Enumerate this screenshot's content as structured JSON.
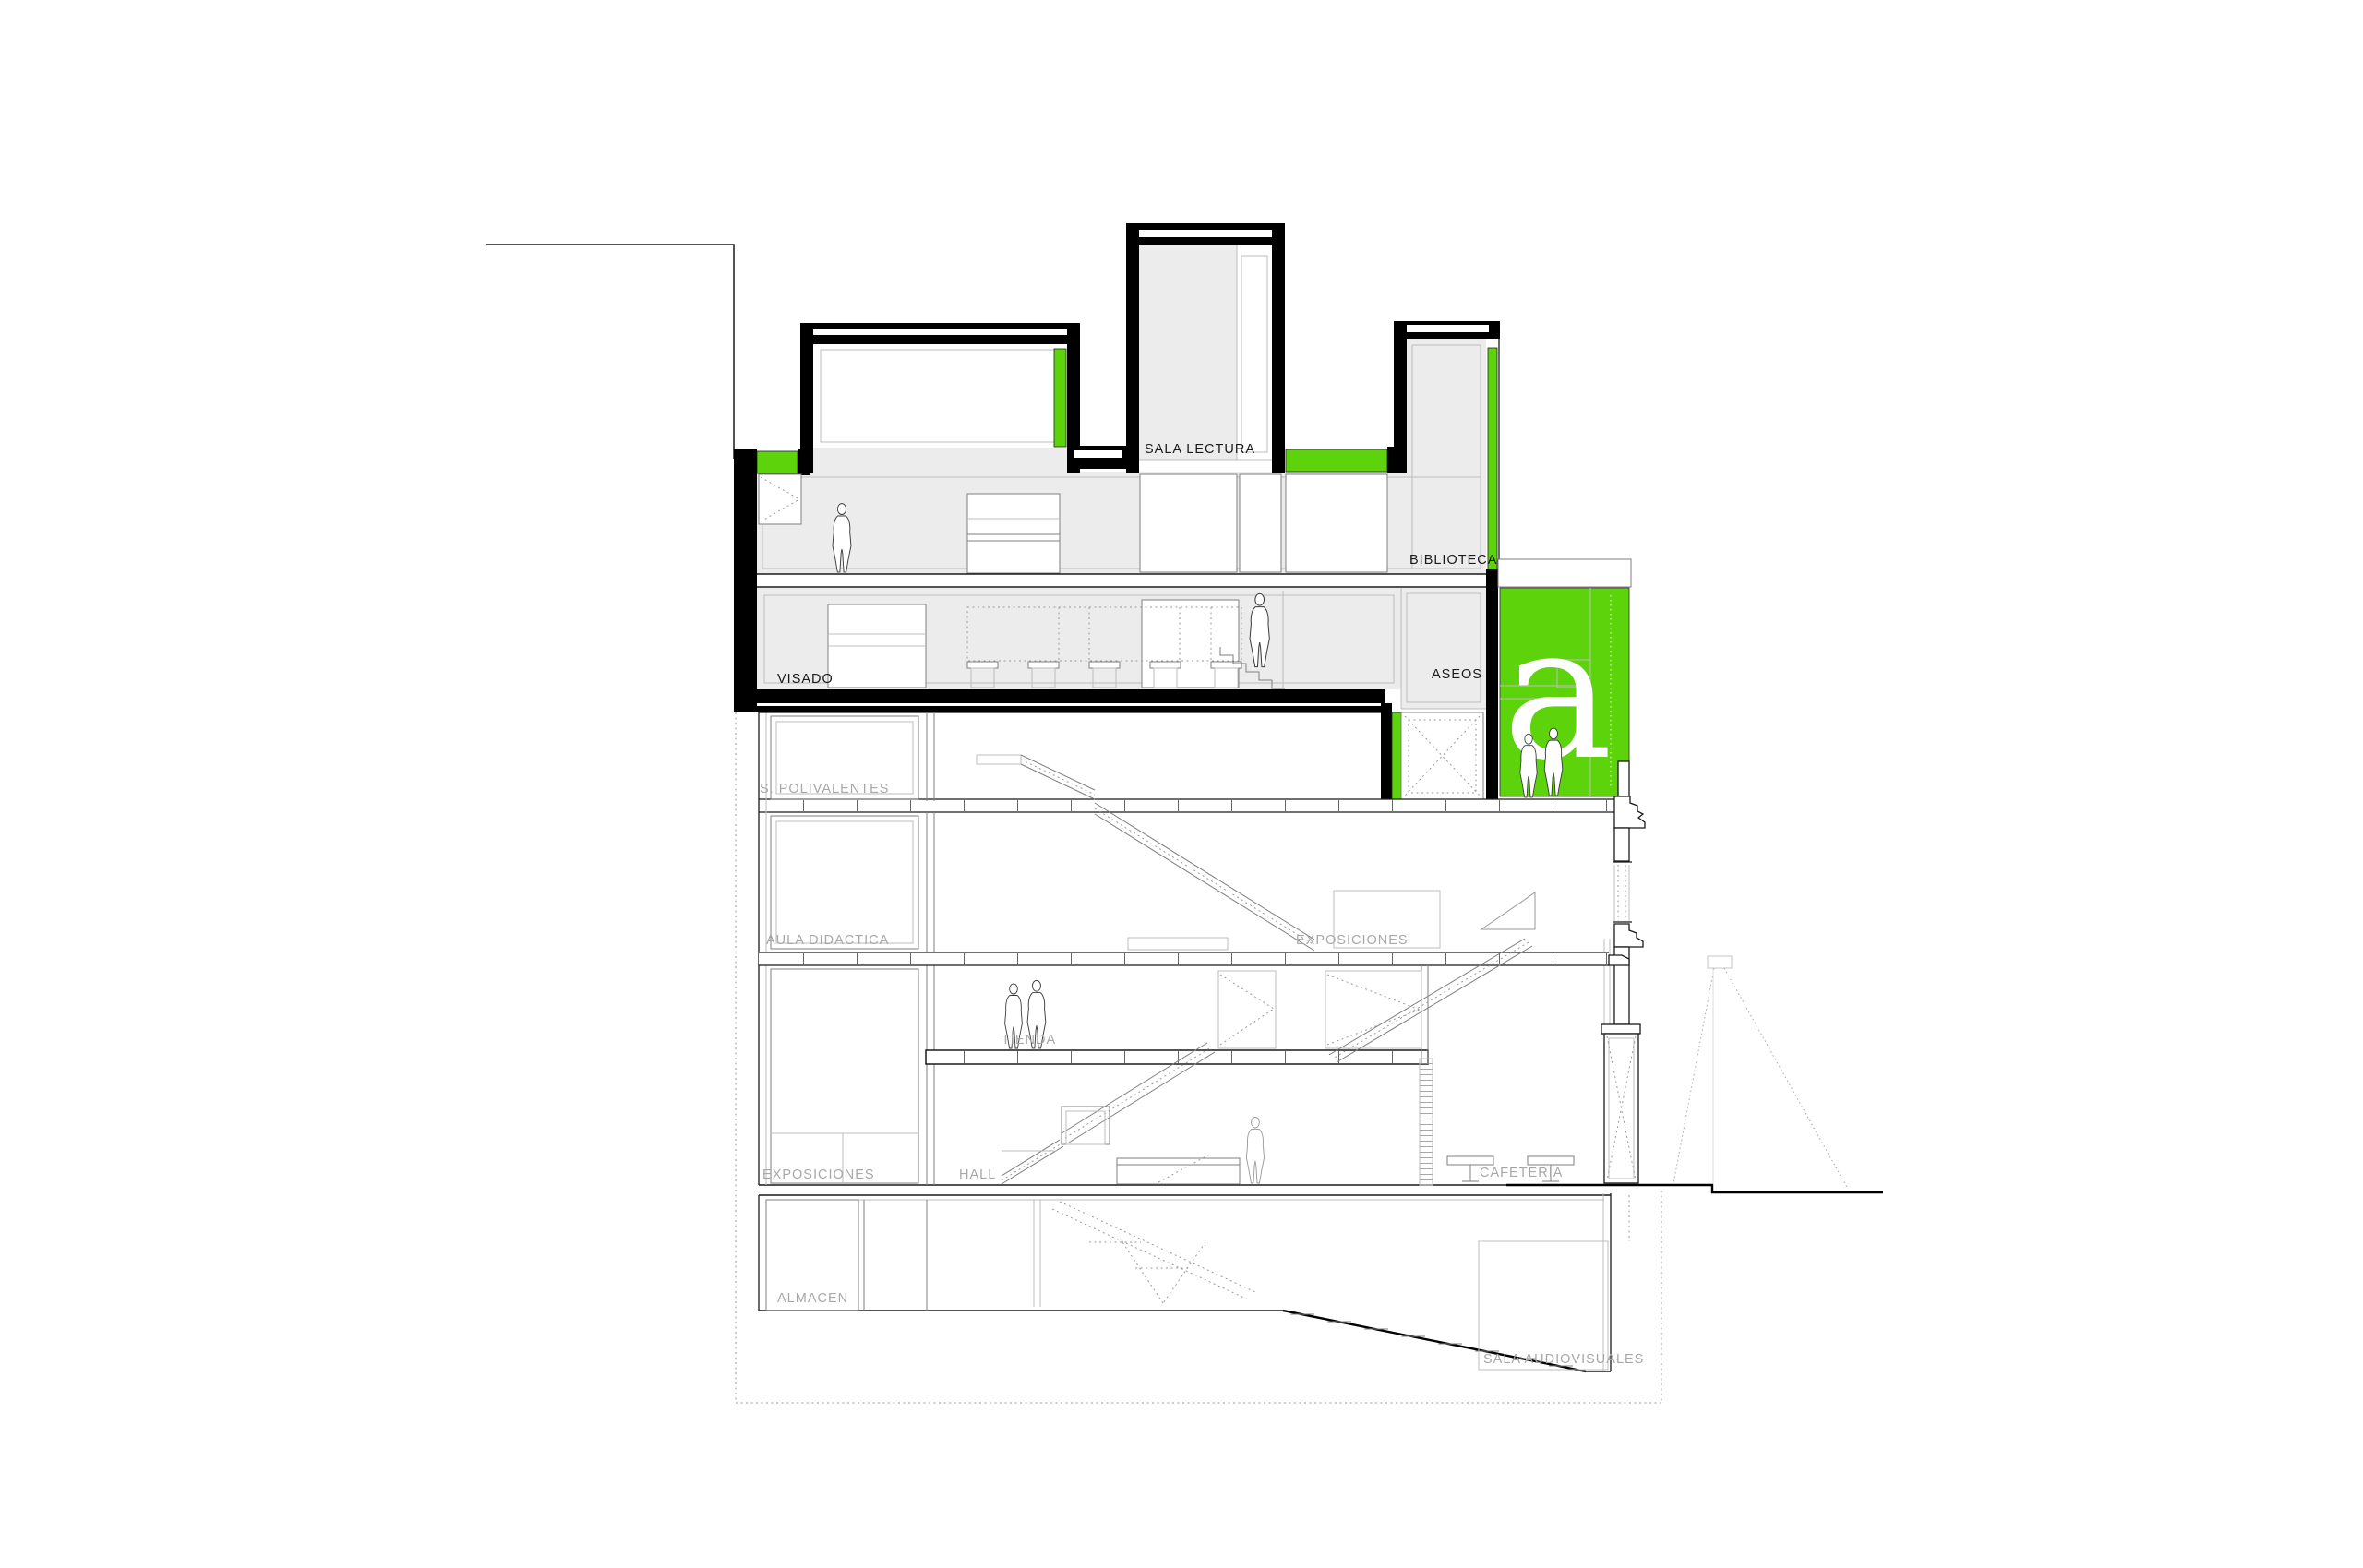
{
  "drawing": {
    "type": "architectural-section",
    "labels": {
      "sala_lectura": "SALA LECTURA",
      "biblioteca": "BIBLIOTECA",
      "visado": "VISADO",
      "aseos": "ASEOS",
      "s_polivalentes": "S. POLIVALENTES",
      "aula_didactica": "AULA DIDACTICA",
      "exposiciones_upper": "EXPOSICIONES",
      "tienda": "TIENDA",
      "exposiciones_ground": "EXPOSICIONES",
      "hall": "HALL",
      "cafeteria": "CAFETERIA",
      "almacen": "ALMACEN",
      "sala_audiovisuales": "SALA AUDIOVISUALES"
    },
    "logo": {
      "letter": "a"
    },
    "colors": {
      "accent_green": "#5CD30A",
      "room_fill": "#ECECEC",
      "label_gray": "#A8A8A8",
      "label_black": "#1A1A1A",
      "structure_black": "#000000",
      "background": "#FFFFFF"
    }
  }
}
